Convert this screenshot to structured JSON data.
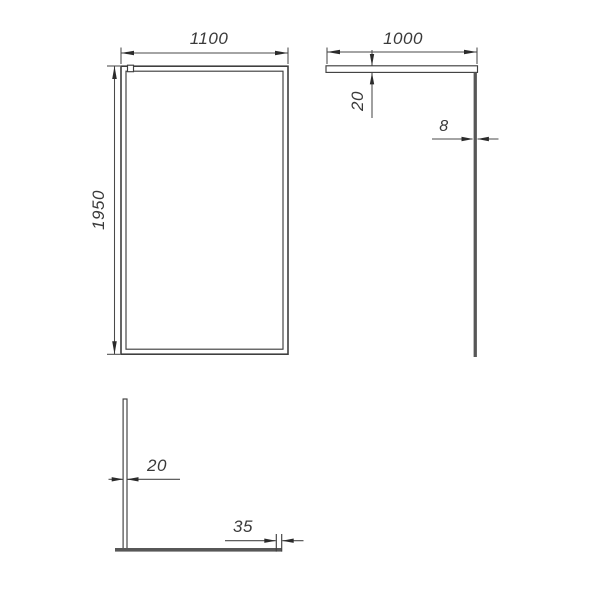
{
  "drawing": {
    "views": {
      "front": {
        "width_label": "1100",
        "height_label": "1950"
      },
      "side": {
        "length_label": "1000",
        "bar_thickness_label": "20",
        "glass_thickness_label": "8"
      },
      "top": {
        "bar_thickness_label": "20",
        "wall_profile_width_label": "35"
      }
    },
    "colors": {
      "background": "#ffffff",
      "line": "#3f3f3f",
      "dim_line": "#4a4a4a",
      "solid_bar": "#575757",
      "text": "#3a3a3a"
    }
  }
}
